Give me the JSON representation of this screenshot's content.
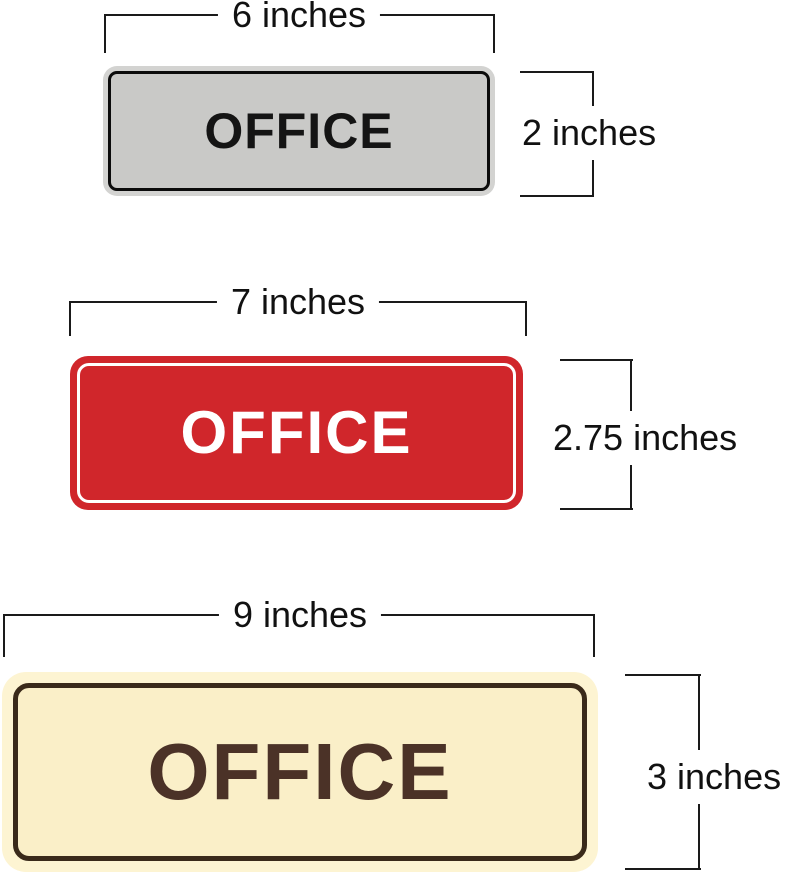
{
  "page": {
    "background": "#ffffff",
    "description_labels": [
      "6 inches",
      "2 inches",
      "7 inches",
      "2.75 inches",
      "9 inches",
      "3 inches"
    ]
  },
  "dimension_line_color": "#1a1a1a",
  "signs": [
    {
      "id": "silver-office-sign",
      "label": "OFFICE",
      "width_label": "6 inches",
      "height_label": "2 inches",
      "colors": {
        "rim": "#d3d3d1",
        "face": "#c9c9c7",
        "border": "#0b0b0b",
        "text": "#141414"
      }
    },
    {
      "id": "red-office-sign",
      "label": "OFFICE",
      "width_label": "7 inches",
      "height_label": "2.75 inches",
      "colors": {
        "rim": "#d0262b",
        "face": "#d0262b",
        "border": "#ffffff",
        "text": "#ffffff"
      }
    },
    {
      "id": "cream-office-sign",
      "label": "OFFICE",
      "width_label": "9 inches",
      "height_label": "3 inches",
      "colors": {
        "rim": "#fdf4d2",
        "face": "#faefc8",
        "border": "#3a2a1a",
        "text": "#4b3227"
      }
    }
  ]
}
